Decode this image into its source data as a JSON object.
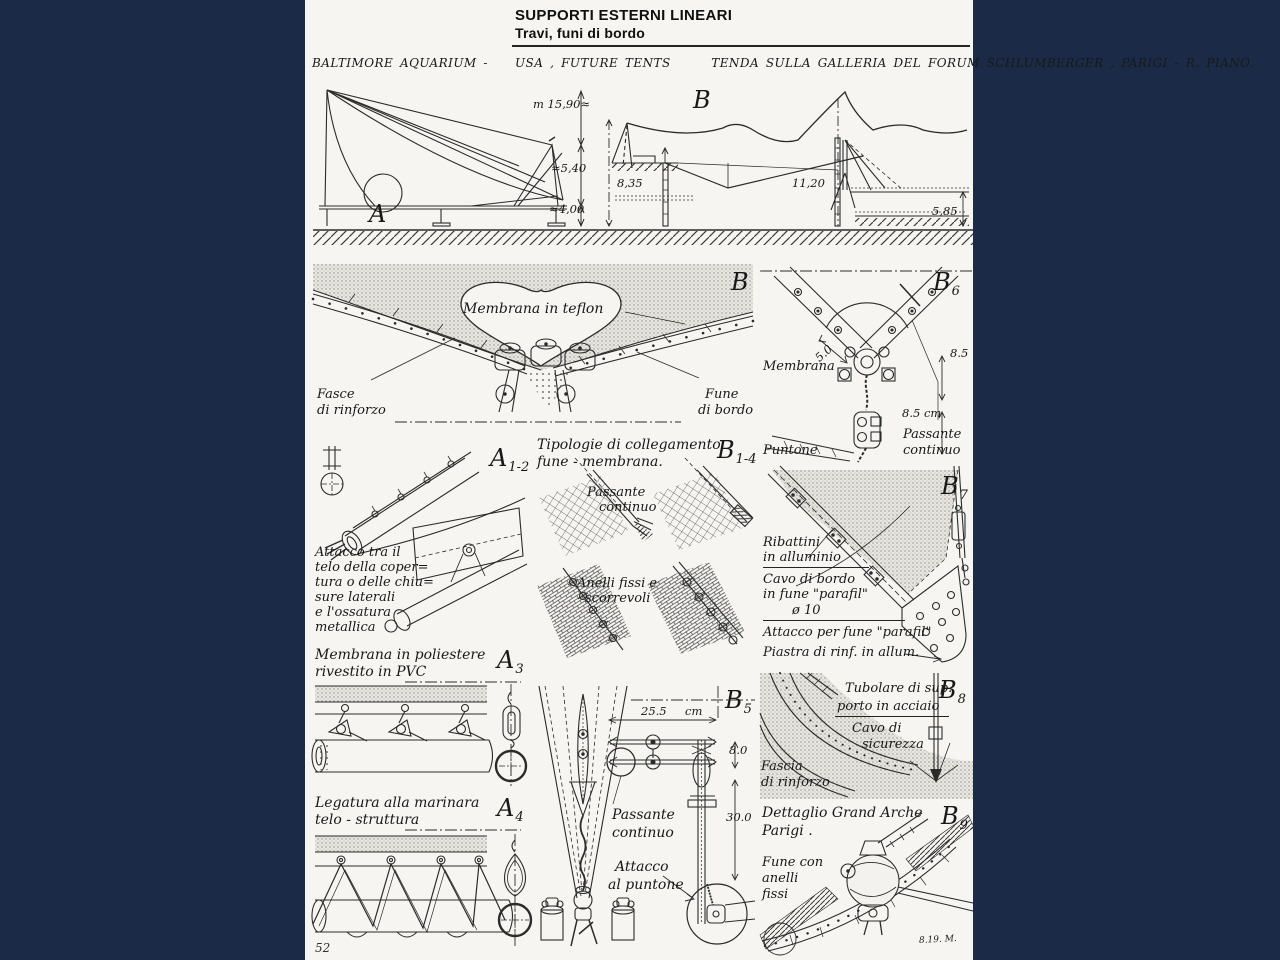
{
  "colors": {
    "background": "#1b2b47",
    "paper": "#f6f5f1",
    "ink": "#242424"
  },
  "page": {
    "number": "52",
    "signature": "8.19. M."
  },
  "header": {
    "title": "SUPPORTI ESTERNI LINEARI",
    "subtitle": "Travi, funi di bordo",
    "caption": "BALTIMORE AQUARIUM -    USA , FUTURE TENTS      TENDA SULLA GALLERIA DEL FORUM SCHLUMBERGER , PARIGI - R. PIANO."
  },
  "elevation_a": {
    "letter": "A",
    "dims": {
      "height": "m 15,90≈",
      "upper": "≈5,40",
      "lower": "≈4,00"
    }
  },
  "elevation_b": {
    "letter": "B",
    "dims": {
      "left": "8,35",
      "center": "11,20",
      "right": "5,85"
    }
  },
  "panel_b": {
    "letter": "B",
    "membrane": "Membrana in teflon",
    "left_label": [
      "Fasce",
      "di rinforzo"
    ],
    "right_label": [
      "Fune",
      "di bordo"
    ]
  },
  "panel_b6": {
    "letter": "B",
    "sub": "6",
    "membrana": "Membrana",
    "puntone": "Puntone",
    "passante": [
      "Passante",
      "continuo"
    ],
    "dims": {
      "width": "5.0",
      "upper": "8.5",
      "lower": "8.5 cm"
    }
  },
  "panel_a12": {
    "letter": "A",
    "sub": "1-2",
    "text": [
      "Attacco tra il",
      "telo della coper=",
      "tura o delle chiu=",
      "sure laterali",
      "e l'ossatura",
      "metallica"
    ]
  },
  "panel_b14": {
    "letter": "B",
    "sub": "1-4",
    "title": [
      "Tipologie di collegamento",
      "fune - membrana."
    ],
    "passante": [
      "Passante",
      "continuo"
    ],
    "anelli": [
      "Anelli fissi e",
      "scorrevoli"
    ]
  },
  "panel_b7": {
    "letter": "B",
    "sub": "7",
    "ribattini": [
      "Ribattini",
      "in alluminio"
    ],
    "cavo": [
      "Cavo di bordo",
      "in fune \"parafil\"",
      "ø 10"
    ],
    "attacco": "Attacco per fune \"parafil\"",
    "piastra": "Piastra di rinf. in allum."
  },
  "panel_a3": {
    "letter": "A",
    "sub": "3",
    "title": [
      "Membrana in poliestere",
      "rivestito in PVC"
    ]
  },
  "panel_a4": {
    "letter": "A",
    "sub": "4",
    "title": [
      "Legatura alla marinara",
      "telo - struttura"
    ]
  },
  "panel_b5": {
    "letter": "B",
    "sub": "5",
    "passante": [
      "Passante",
      "continuo"
    ],
    "attacco": [
      "Attacco",
      "al puntone"
    ],
    "dims": {
      "width": "25.5",
      "width_unit": "cm",
      "upper": "8.0",
      "lower": "30.0"
    }
  },
  "panel_b8": {
    "letter": "B",
    "sub": "8",
    "tubolare": [
      "Tubolare di sup.",
      "porto in acciaio"
    ],
    "cavo": [
      "Cavo di",
      "sicurezza"
    ],
    "fascia": [
      "Fascia",
      "di rinforzo"
    ]
  },
  "panel_b9": {
    "letter": "B",
    "sub": "9",
    "title": [
      "Dettaglio Grand Arche",
      "Parigi ."
    ],
    "fune": [
      "Fune con",
      "anelli",
      "fissi"
    ]
  }
}
